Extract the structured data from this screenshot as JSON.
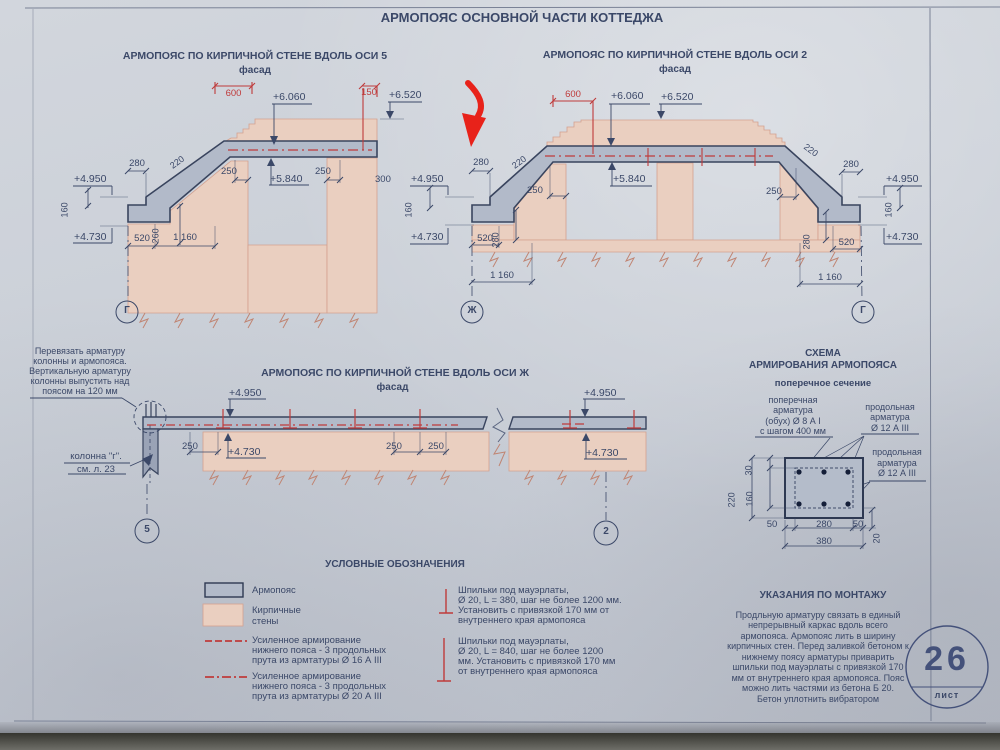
{
  "page": {
    "title": "АРМОПОЯС ОСНОВНОЙ ЧАСТИ КОТТЕДЖА"
  },
  "colors": {
    "ink": "#3b4868",
    "red": "#bf3b3b",
    "arrow_red": "#e8221a",
    "armopoyas_fill": "#b2bac9",
    "brick_fill": "#eacfc0"
  },
  "drawing_axis5": {
    "title": "АРМОПОЯС ПО КИРПИЧНОЙ СТЕНЕ ВДОЛЬ ОСИ 5",
    "subtitle": "фасад",
    "axis_bottom": "Г",
    "dims": {
      "w600": "600",
      "w150": "150",
      "e6060": "+6.060",
      "e6520": "+6.520",
      "t220": "220",
      "w280": "280",
      "e4950": "+4.950",
      "h160": "160",
      "e4730": "+4.730",
      "w520": "520",
      "w1160": "1 160",
      "h260": "260",
      "w250l": "250",
      "e5840": "+5.840",
      "w250r": "250",
      "w300": "300"
    }
  },
  "drawing_axis2": {
    "title": "АРМОПОЯС ПО КИРПИЧНОЙ СТЕНЕ ВДОЛЬ ОСИ 2",
    "subtitle": "фасад",
    "axis_bottom_left": "Ж",
    "axis_bottom_right": "Г",
    "dims": {
      "w600": "600",
      "e6060": "+6.060",
      "e6520": "+6.520",
      "t220l": "220",
      "t220r": "220",
      "w280l": "280",
      "w280r": "280",
      "e4950l": "+4.950",
      "e4950r": "+4.950",
      "h160l": "160",
      "h160r": "160",
      "e4730l": "+4.730",
      "e4730r": "+4.730",
      "w520l": "520",
      "w520r": "520",
      "h280l": "280",
      "h280r": "280",
      "w250l": "250",
      "w250r": "250",
      "e5840": "+5.840",
      "w1160l": "1 160",
      "w1160r": "1 160"
    }
  },
  "drawing_axis_zh": {
    "title": "АРМОПОЯС ПО КИРПИЧНОЙ СТЕНЕ ВДОЛЬ ОСИ Ж",
    "subtitle": "фасад",
    "axis_bottom_left": "5",
    "axis_bottom_right": "2",
    "note_tie": [
      "Перевязать арматуру",
      "колонны и армопояса.",
      "Вертикальную арматуру",
      "колонны выпустить над",
      "поясом на 120 мм"
    ],
    "note_column": [
      "колонна \"г\".",
      "см. л. 23"
    ],
    "dims": {
      "e4950l": "+4.950",
      "e4950r": "+4.950",
      "e4730l": "+4.730",
      "e4730r": "+4.730",
      "w250a": "250",
      "w250b": "250",
      "w250c": "250"
    }
  },
  "rebar_schema": {
    "title_line1": "СХЕМА",
    "title_line2": "АРМИРОВАНИЯ АРМОПОЯСА",
    "subtitle": "поперечное сечение",
    "label_transverse": [
      "поперечная",
      "арматура",
      "(обух) Ø 8 А I",
      "с шагом 400 мм"
    ],
    "label_longitudinal_top": [
      "продольная",
      "арматура",
      "Ø 12 А III"
    ],
    "label_longitudinal_bottom": [
      "продольная",
      "арматура",
      "Ø 12 А III"
    ],
    "dims": {
      "h30": "30",
      "h220": "220",
      "h160": "160",
      "w50l": "50",
      "w280": "280",
      "w50r": "50",
      "h20": "20",
      "w380": "380"
    }
  },
  "legend": {
    "title": "УСЛОВНЫЕ ОБОЗНАЧЕНИЯ",
    "armopoyas": "Армопояс",
    "brick": [
      "Кирпичные",
      "стены"
    ],
    "reinforced16": [
      "Усиленное армирование",
      "нижнего пояса - 3 продольных",
      "прута из армтатуры Ø 16 А III"
    ],
    "reinforced20": [
      "Усиленное армирование",
      "нижнего пояса - 3 продольных",
      "прута из армтатуры Ø 20 А III"
    ],
    "studs380": [
      "Шпильки под мауэрлаты,",
      "Ø 20, L = 380, шаг не более 1200 мм.",
      "Установить с привязкой 170 мм от",
      "внутреннего края армопояса"
    ],
    "studs840": [
      "Шпильки под мауэрлаты,",
      "Ø 20, L = 840, шаг не более 1200",
      "мм. Установить с привязкой 170 мм",
      "от внутреннего края армопояса"
    ]
  },
  "montage": {
    "title": "УКАЗАНИЯ ПО МОНТАЖУ",
    "lines": [
      "Продльную арматуру связать в единый",
      "непрерывный каркас вдоль всего",
      "армопояса. Армопояс лить в ширину",
      "кирпичных стен. Перед заливкой бетоном к",
      "нижнему поясу арматуры приварить",
      "шпильки под мауэрлаты с привязкой 170",
      "мм от внутреннего края армопояса. Пояс",
      "можно лить частями из бетона Б 20.",
      "Бетон уплотнить вибратором"
    ]
  },
  "sheet": {
    "number": "26",
    "label": "лист"
  }
}
